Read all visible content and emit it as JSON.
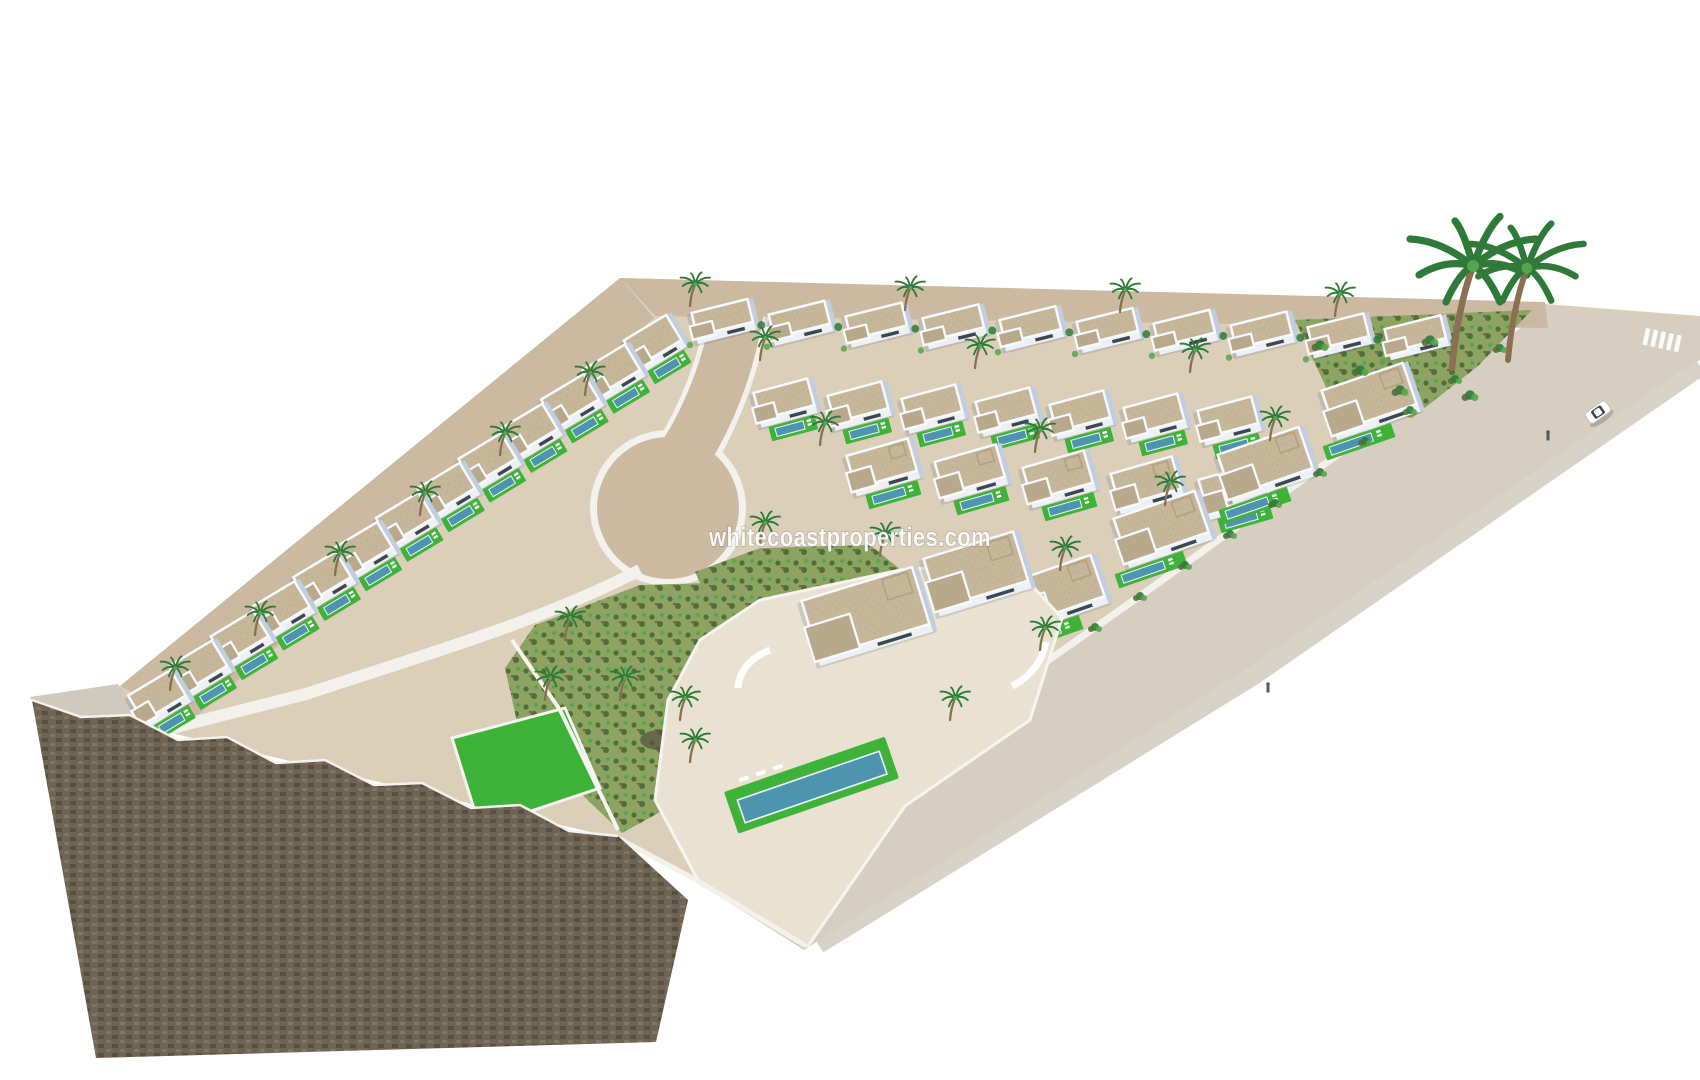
{
  "image": {
    "kind": "aerial-3d-architectural-render",
    "subject": "white villa residential development with private pools, access roads, cul-de-sac, green zones, palm trees and a stone retaining wall, isolated on a white background",
    "watermark_text": "whitecoastproperties.com"
  },
  "counts": {
    "left_row_villas": 13,
    "upper_row_1_villas": 10,
    "upper_row_2_villas": 7,
    "upper_row_3_villas": 5,
    "right_cluster_villas": 4,
    "foreground_villas": 1,
    "tall_palm_trees": 2,
    "cars": 1,
    "zebra_crossings": 1
  },
  "colors": {
    "background": "#ffffff",
    "ground": "#dbcfba",
    "road": "#cbb9a2",
    "road_right": "#d6cfc1",
    "sidewalk": "#f3f1ec",
    "bevel": "#d8d3c9",
    "villa_white": "#f7f9fb",
    "villa_face": "#edf1f6",
    "villa_shade": "#c2cedd",
    "window_dark": "#3d4750",
    "roof": "#c6b69a",
    "roof_dark": "#b8a88c",
    "pergola": "#b3a184",
    "pool": "#4f94ae",
    "pool_edge": "#eaf4f7",
    "lawn": "#3fb23a",
    "scrub": "#8ca361",
    "scrub_dark": "#4e7038",
    "rock": "#77674f",
    "brick": "#6e6355",
    "brick_dark": "#57503f",
    "brick_light": "#81765f",
    "slope_grey": "#cfc9be",
    "wall_light": "#f1eee6",
    "palm_green": "#2f7a38",
    "palm_light": "#58a44e",
    "trunk": "#8a6f52",
    "car_body": "#ffffff",
    "car_trim": "#b9bcc0",
    "car_glass": "#3c444c",
    "person": "#555a60",
    "shadow": "rgba(70,80,100,0.16)",
    "watermark": "rgba(255,255,255,0.93)",
    "watermark_outline": "rgba(96,96,96,0.40)"
  }
}
